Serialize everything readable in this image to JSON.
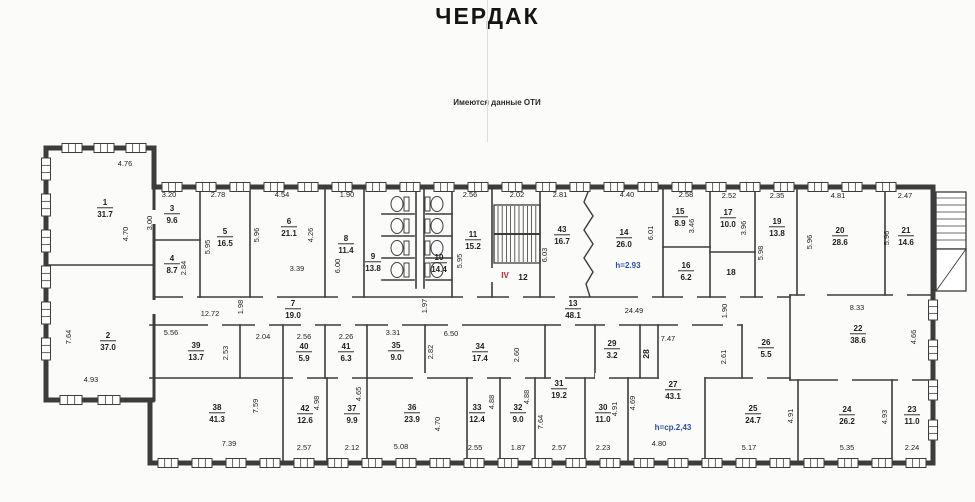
{
  "title": "ЧЕРДАК",
  "note": "Имеются данные ОТИ",
  "colors": {
    "paper": "#fbfbf9",
    "line": "#3c3c3c",
    "text": "#1d1d1d",
    "red": "#c1272d",
    "blue": "#2b4fad"
  },
  "plan": {
    "rooms": [
      [
        "1",
        "31.7",
        105,
        207
      ],
      [
        "2",
        "37.0",
        108,
        340
      ],
      [
        "3",
        "9.6",
        172,
        213
      ],
      [
        "4",
        "8.7",
        172,
        263
      ],
      [
        "5",
        "16.5",
        225,
        236
      ],
      [
        "6",
        "21.1",
        289,
        226
      ],
      [
        "7",
        "19.0",
        293,
        308
      ],
      [
        "8",
        "11.4",
        346,
        243
      ],
      [
        "9",
        "13.8",
        373,
        261
      ],
      [
        "10",
        "14.4",
        439,
        262
      ],
      [
        "11",
        "15.2",
        473,
        239
      ],
      [
        "12",
        null,
        523,
        277,
        0
      ],
      [
        "13",
        "48.1",
        573,
        308
      ],
      [
        "14",
        "26.0",
        624,
        237
      ],
      [
        "15",
        "8.9",
        680,
        216
      ],
      [
        "16",
        "6.2",
        686,
        270
      ],
      [
        "17",
        "10.0",
        728,
        217
      ],
      [
        "18",
        null,
        731,
        272,
        0
      ],
      [
        "19",
        "13.8",
        777,
        226
      ],
      [
        "20",
        "28.6",
        840,
        235
      ],
      [
        "21",
        "14.6",
        906,
        235
      ],
      [
        "22",
        "38.6",
        858,
        333
      ],
      [
        "23",
        "11.0",
        912,
        414
      ],
      [
        "24",
        "26.2",
        847,
        414
      ],
      [
        "25",
        "24.7",
        753,
        413
      ],
      [
        "26",
        "5.5",
        766,
        347
      ],
      [
        "27",
        "43.1",
        673,
        389
      ],
      [
        "28",
        null,
        649,
        351,
        -90
      ],
      [
        "29",
        "3.2",
        612,
        348
      ],
      [
        "30",
        "11.0",
        603,
        412
      ],
      [
        "31",
        "19.2",
        559,
        388
      ],
      [
        "32",
        "9.0",
        518,
        412
      ],
      [
        "33",
        "12.4",
        477,
        412
      ],
      [
        "34",
        "17.4",
        480,
        351
      ],
      [
        "35",
        "9.0",
        396,
        350
      ],
      [
        "36",
        "23.9",
        412,
        412
      ],
      [
        "37",
        "9.9",
        352,
        413
      ],
      [
        "38",
        "41.3",
        217,
        412
      ],
      [
        "39",
        "13.7",
        196,
        350
      ],
      [
        "40",
        "5.9",
        304,
        351
      ],
      [
        "41",
        "6.3",
        346,
        351
      ],
      [
        "42",
        "12.6",
        305,
        413
      ],
      [
        "43",
        "16.7",
        562,
        234
      ]
    ],
    "dims_h": [
      [
        "4.76",
        125,
        166
      ],
      [
        "3.20",
        169,
        197
      ],
      [
        "2.78",
        218,
        197
      ],
      [
        "4.54",
        282,
        197
      ],
      [
        "1.90",
        347,
        197
      ],
      [
        "2.56",
        470,
        197
      ],
      [
        "2.02",
        517,
        197
      ],
      [
        "2.81",
        560,
        197
      ],
      [
        "4.40",
        627,
        197
      ],
      [
        "2.58",
        686,
        197
      ],
      [
        "2.52",
        729,
        198
      ],
      [
        "2.35",
        777,
        198
      ],
      [
        "4.81",
        838,
        198
      ],
      [
        "2.47",
        905,
        198
      ],
      [
        "3.39",
        297,
        271
      ],
      [
        "4.93",
        91,
        382
      ],
      [
        "12.72",
        210,
        316
      ],
      [
        "5.56",
        171,
        335
      ],
      [
        "2.04",
        263,
        339
      ],
      [
        "2.56",
        304,
        339
      ],
      [
        "2.26",
        346,
        339
      ],
      [
        "3.31",
        393,
        335
      ],
      [
        "6.50",
        451,
        336
      ],
      [
        "24.49",
        634,
        313
      ],
      [
        "7.47",
        668,
        341
      ],
      [
        "8.33",
        857,
        310
      ],
      [
        "7.39",
        229,
        446
      ],
      [
        "2.57",
        304,
        450
      ],
      [
        "2.12",
        352,
        450
      ],
      [
        "5.08",
        401,
        449
      ],
      [
        "2.55",
        475,
        450
      ],
      [
        "1.87",
        518,
        450
      ],
      [
        "2.57",
        559,
        450
      ],
      [
        "2.23",
        603,
        450
      ],
      [
        "4.80",
        659,
        446
      ],
      [
        "5.17",
        749,
        450
      ],
      [
        "5.35",
        847,
        450
      ],
      [
        "2.24",
        912,
        450
      ]
    ],
    "dims_v": [
      [
        "4.70",
        128,
        234
      ],
      [
        "3.00",
        152,
        223
      ],
      [
        "2.84",
        186,
        268
      ],
      [
        "5.95",
        210,
        247
      ],
      [
        "5.96",
        259,
        235
      ],
      [
        "4.26",
        313,
        235
      ],
      [
        "6.00",
        340,
        266
      ],
      [
        "5.95",
        462,
        261
      ],
      [
        "6.03",
        547,
        255
      ],
      [
        "6.01",
        653,
        233
      ],
      [
        "3.46",
        694,
        226
      ],
      [
        "3.96",
        746,
        228
      ],
      [
        "5.98",
        763,
        253
      ],
      [
        "5.96",
        812,
        242
      ],
      [
        "5.96",
        889,
        238
      ],
      [
        "7.64",
        71,
        337
      ],
      [
        "1.98",
        243,
        307
      ],
      [
        "1.97",
        427,
        306
      ],
      [
        "1.90",
        727,
        311
      ],
      [
        "2.53",
        228,
        353
      ],
      [
        "2.82",
        433,
        352
      ],
      [
        "2.60",
        519,
        355
      ],
      [
        "2.61",
        726,
        357
      ],
      [
        "4.66",
        916,
        337
      ],
      [
        "7.59",
        258,
        406
      ],
      [
        "4.98",
        319,
        403
      ],
      [
        "4.65",
        361,
        394
      ],
      [
        "4.70",
        440,
        424
      ],
      [
        "4.88",
        494,
        402
      ],
      [
        "4.88",
        529,
        397
      ],
      [
        "7.64",
        543,
        422
      ],
      [
        "4.91",
        617,
        409
      ],
      [
        "4.69",
        635,
        403
      ],
      [
        "4.91",
        793,
        416
      ],
      [
        "4.93",
        887,
        417
      ]
    ],
    "specials": [
      [
        "IV",
        505,
        278,
        "red"
      ],
      [
        "h=2.93",
        628,
        268,
        "blue"
      ],
      [
        "h=ср.2,43",
        673,
        430,
        "blue"
      ]
    ],
    "walls_ext": [
      [
        46,
        148,
        154,
        148
      ],
      [
        46,
        148,
        46,
        400
      ],
      [
        46,
        400,
        152,
        400
      ],
      [
        154,
        148,
        154,
        187
      ],
      [
        154,
        187,
        933,
        187
      ],
      [
        933,
        187,
        933,
        463
      ],
      [
        150,
        400,
        150,
        463
      ],
      [
        150,
        463,
        933,
        463
      ]
    ],
    "walls_mid": [
      [
        154,
        187,
        154,
        400
      ]
    ],
    "walls_int": [
      [
        200,
        187,
        200,
        297
      ],
      [
        250,
        187,
        250,
        297
      ],
      [
        325,
        187,
        325,
        297
      ],
      [
        364,
        187,
        364,
        297
      ],
      [
        416,
        190,
        416,
        288
      ],
      [
        424,
        190,
        424,
        288
      ],
      [
        452,
        187,
        452,
        297
      ],
      [
        492,
        187,
        492,
        297
      ],
      [
        540,
        187,
        540,
        297
      ],
      [
        663,
        187,
        663,
        297
      ],
      [
        710,
        187,
        710,
        297
      ],
      [
        755,
        187,
        755,
        297
      ],
      [
        797,
        187,
        797,
        295
      ],
      [
        885,
        187,
        885,
        295
      ],
      [
        154,
        240,
        200,
        240
      ],
      [
        663,
        247,
        710,
        247
      ],
      [
        710,
        252,
        755,
        252
      ],
      [
        382,
        214,
        414,
        214
      ],
      [
        382,
        236,
        414,
        236
      ],
      [
        382,
        258,
        414,
        258
      ],
      [
        382,
        280,
        414,
        280
      ],
      [
        426,
        214,
        452,
        214
      ],
      [
        426,
        236,
        452,
        236
      ],
      [
        426,
        258,
        452,
        258
      ],
      [
        426,
        280,
        452,
        280
      ],
      [
        154,
        297,
        790,
        297
      ],
      [
        150,
        325,
        742,
        325
      ],
      [
        790,
        295,
        933,
        295
      ],
      [
        790,
        295,
        790,
        380
      ],
      [
        790,
        380,
        933,
        380
      ],
      [
        46,
        265,
        154,
        265
      ],
      [
        240,
        325,
        240,
        378
      ],
      [
        283,
        325,
        283,
        378
      ],
      [
        325,
        325,
        325,
        378
      ],
      [
        367,
        325,
        367,
        378
      ],
      [
        425,
        325,
        425,
        378
      ],
      [
        545,
        325,
        545,
        378
      ],
      [
        595,
        325,
        595,
        378
      ],
      [
        640,
        325,
        640,
        378
      ],
      [
        658,
        325,
        658,
        378
      ],
      [
        742,
        325,
        742,
        378
      ],
      [
        150,
        378,
        658,
        378
      ],
      [
        705,
        378,
        790,
        378
      ],
      [
        283,
        378,
        283,
        463
      ],
      [
        327,
        378,
        327,
        463
      ],
      [
        367,
        378,
        367,
        463
      ],
      [
        467,
        378,
        467,
        463
      ],
      [
        500,
        378,
        500,
        463
      ],
      [
        535,
        378,
        535,
        463
      ],
      [
        585,
        378,
        585,
        463
      ],
      [
        628,
        378,
        628,
        463
      ],
      [
        705,
        378,
        705,
        463
      ],
      [
        798,
        380,
        798,
        463
      ],
      [
        892,
        380,
        892,
        463
      ]
    ],
    "zigzag": [
      [
        590,
        187
      ],
      [
        584,
        202
      ],
      [
        593,
        216
      ],
      [
        584,
        230
      ],
      [
        593,
        244
      ],
      [
        584,
        258
      ],
      [
        593,
        272
      ],
      [
        586,
        284
      ],
      [
        590,
        297
      ]
    ],
    "door_gaps": [
      [
        183,
        292,
        14,
        9
      ],
      [
        263,
        292,
        14,
        9
      ],
      [
        338,
        292,
        14,
        9
      ],
      [
        463,
        292,
        14,
        9
      ],
      [
        509,
        292,
        14,
        9
      ],
      [
        555,
        292,
        14,
        9
      ],
      [
        638,
        292,
        14,
        9
      ],
      [
        683,
        292,
        14,
        9
      ],
      [
        726,
        292,
        14,
        9
      ],
      [
        763,
        292,
        14,
        9
      ],
      [
        813,
        292,
        14,
        9
      ],
      [
        893,
        292,
        14,
        9
      ],
      [
        805,
        290,
        14,
        9
      ],
      [
        208,
        320,
        14,
        9
      ],
      [
        255,
        320,
        14,
        9
      ],
      [
        301,
        320,
        14,
        9
      ],
      [
        341,
        320,
        14,
        9
      ],
      [
        388,
        320,
        14,
        9
      ],
      [
        448,
        320,
        14,
        9
      ],
      [
        561,
        320,
        14,
        9
      ],
      [
        605,
        320,
        14,
        9
      ],
      [
        678,
        320,
        14,
        9
      ],
      [
        723,
        320,
        14,
        9
      ],
      [
        293,
        373,
        14,
        9
      ],
      [
        338,
        373,
        14,
        9
      ],
      [
        413,
        373,
        14,
        9
      ],
      [
        473,
        373,
        14,
        9
      ],
      [
        511,
        373,
        14,
        9
      ],
      [
        551,
        373,
        14,
        9
      ],
      [
        595,
        373,
        14,
        9
      ],
      [
        753,
        375,
        14,
        9
      ],
      [
        838,
        375,
        14,
        9
      ],
      [
        898,
        375,
        14,
        9
      ],
      [
        150,
        300,
        8,
        14
      ],
      [
        150,
        210,
        8,
        14
      ],
      [
        488,
        268,
        8,
        14
      ]
    ],
    "window_strips": [
      {
        "o": "h",
        "a": 148,
        "b1": 62,
        "b2": 128,
        "step": 32,
        "w": 20
      },
      {
        "o": "v",
        "a": 46,
        "b1": 158,
        "b2": 372,
        "step": 36,
        "w": 22
      },
      {
        "o": "h",
        "a": 400,
        "b1": 60,
        "b2": 122,
        "step": 38,
        "w": 22
      },
      {
        "o": "h",
        "a": 187,
        "b1": 162,
        "b2": 908,
        "step": 34,
        "w": 20
      },
      {
        "o": "h",
        "a": 463,
        "b1": 158,
        "b2": 908,
        "step": 34,
        "w": 20
      },
      {
        "o": "v",
        "a": 933,
        "b1": 300,
        "b2": 438,
        "step": 40,
        "w": 20
      }
    ],
    "stair": {
      "x": 494,
      "y": 205,
      "w": 46,
      "h": 58
    },
    "ext_stair": {
      "x": 936,
      "y": 192,
      "w": 30,
      "h": 57,
      "lower_h": 42
    },
    "toilets": {
      "cols": [
        {
          "cx": 397,
          "dir": 1
        },
        {
          "cx": 437,
          "dir": -1
        }
      ],
      "rows": [
        204,
        226,
        248,
        270
      ]
    }
  }
}
